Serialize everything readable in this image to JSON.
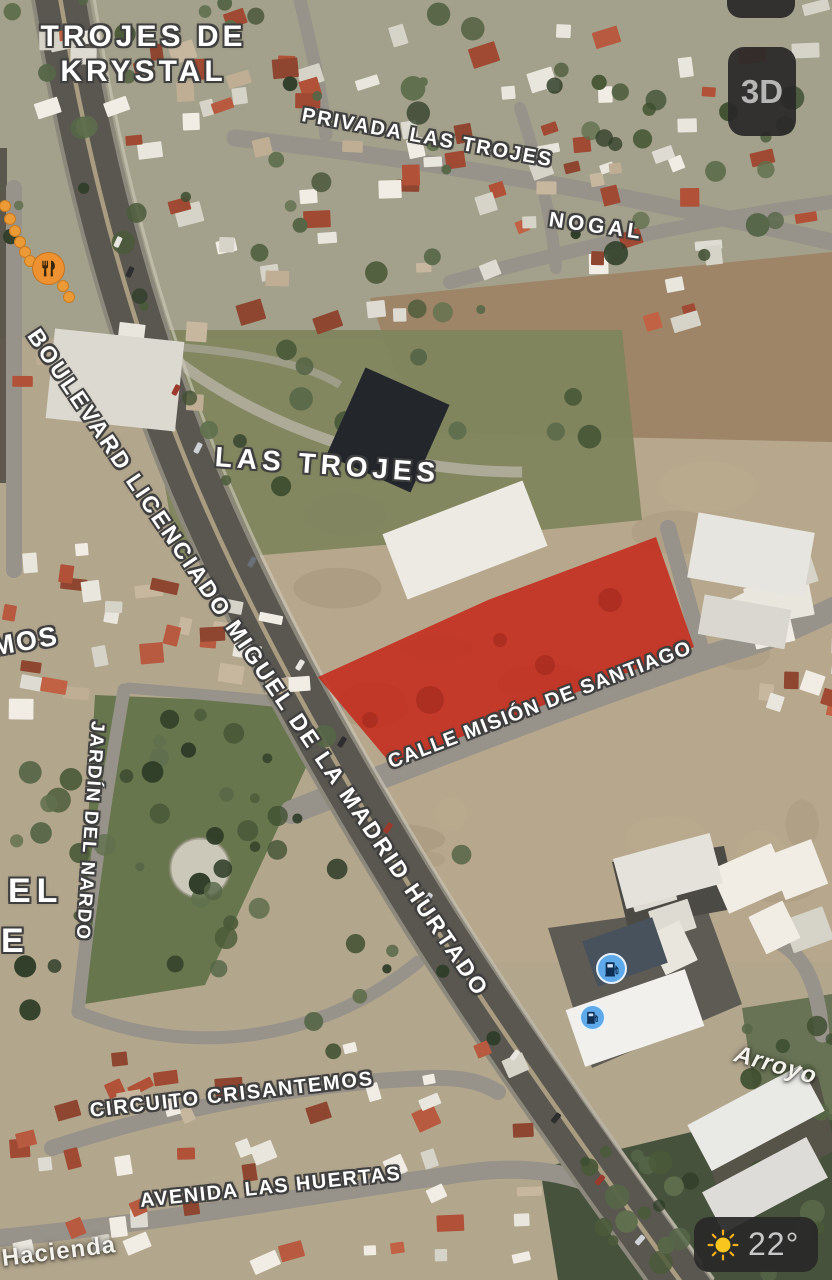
{
  "controls": {
    "view_3d": {
      "label": "3D"
    },
    "weather": {
      "temperature": "22°",
      "icon": "sun-icon"
    }
  },
  "map_labels": {
    "area_top": {
      "line1": "TROJES DE",
      "line2": "KRYSTAL"
    },
    "area_center": "LAS TROJES",
    "street_privada": "PRIVADA LAS TROJES",
    "street_nogal": "NOGAL",
    "street_boulevard": "BOULEVARD LICENCIADO MIGUEL DE LA MADRID HURTADO",
    "street_mision": "CALLE MISIÓN DE SANTIAGO",
    "street_jardin": "JARDÍN DEL NARDO",
    "street_partial_mos": "MOS",
    "area_partial_line1": "EL",
    "area_partial_line2": "E",
    "street_circuito": "CIRCUITO CRISANTEMOS",
    "street_avenida": "AVENIDA LAS HUERTAS",
    "feature_arroyo": "Arroyo",
    "area_hacienda": "Hacienda"
  },
  "pois": {
    "restaurant": {
      "icon": "restaurant-icon",
      "color": "#ee9130"
    },
    "gas_station_1": {
      "icon": "fuel-icon",
      "color": "#5da9ea"
    },
    "gas_station_2": {
      "icon": "fuel-icon",
      "color": "#5da9ea"
    }
  },
  "highlight": {
    "color": "#c52517",
    "opacity": 0.84
  },
  "colors": {
    "control_bg": "#292929",
    "sun_yellow": "#f7c51e",
    "poi_orange": "#ee9130",
    "poi_blue": "#5da9ea",
    "label_white": "#ffffff",
    "label_outline": "#3e3e3e"
  }
}
